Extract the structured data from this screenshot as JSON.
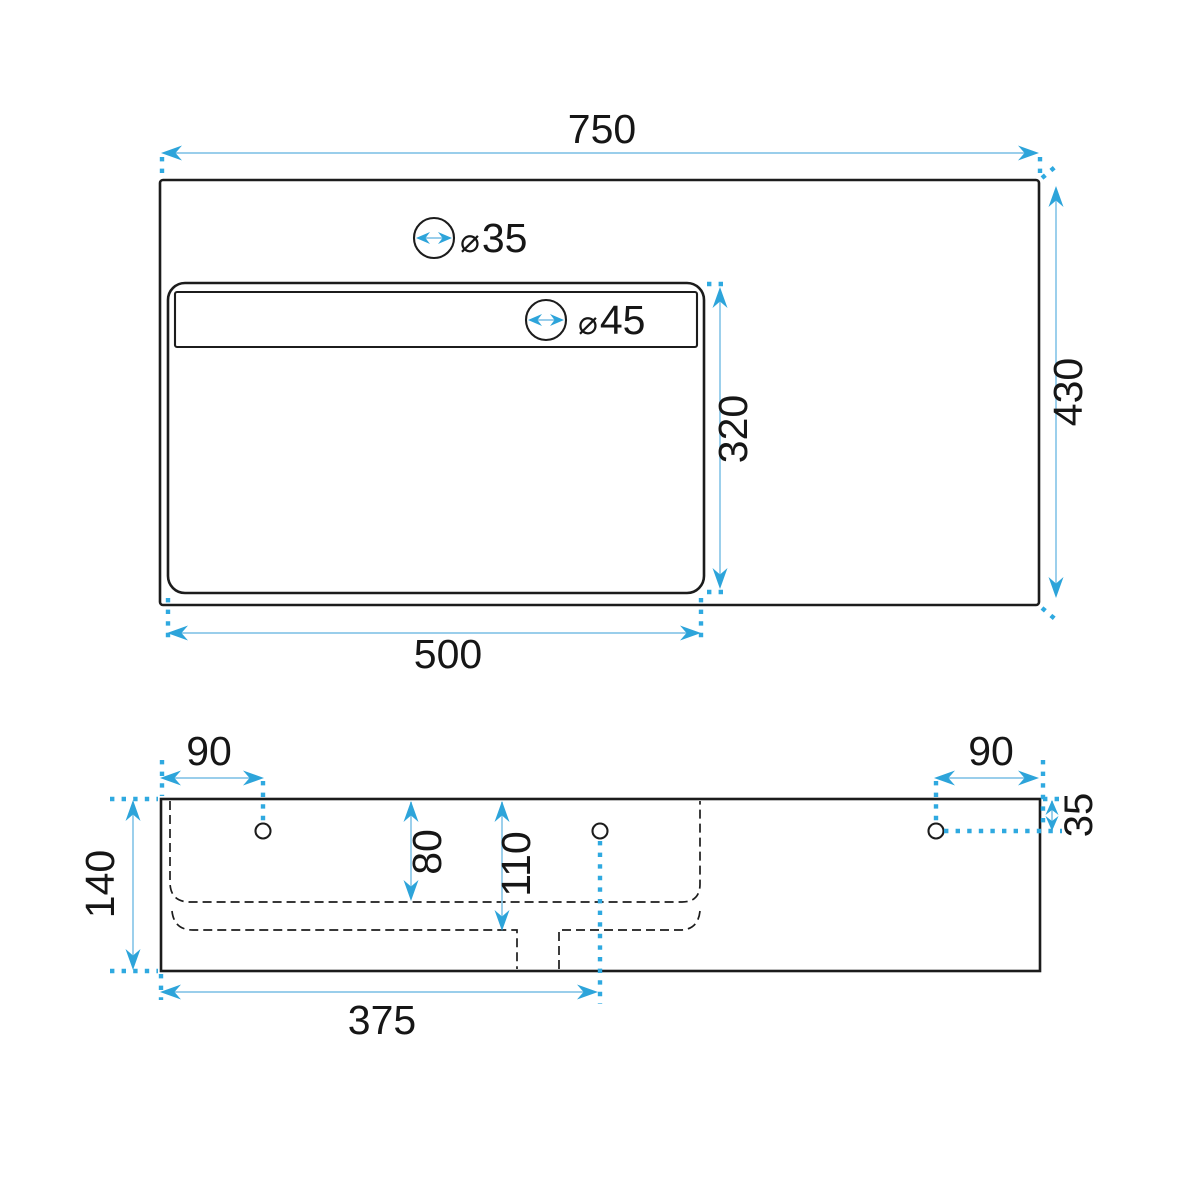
{
  "drawing": {
    "type": "washbasin-dimension-drawing",
    "views": {
      "top": {
        "width": "750",
        "height": "430",
        "basin_width": "500",
        "basin_height": "320",
        "faucet_hole": {
          "symbol": "⌀",
          "value": "35"
        },
        "overflow_hole": {
          "symbol": "⌀",
          "value": "45"
        }
      },
      "front": {
        "height": "140",
        "left_hole_offset": "90",
        "right_hole_offset": "90",
        "hole_top_offset": "35",
        "shelf_depth": "80",
        "basin_depth": "110",
        "drain_offset": "375"
      }
    },
    "colors": {
      "outline": "#1c1c1c",
      "dim_line": "#8bc7e8",
      "arrow": "#2da4da",
      "dotted": "#2fa9e0",
      "background": "#ffffff"
    }
  }
}
